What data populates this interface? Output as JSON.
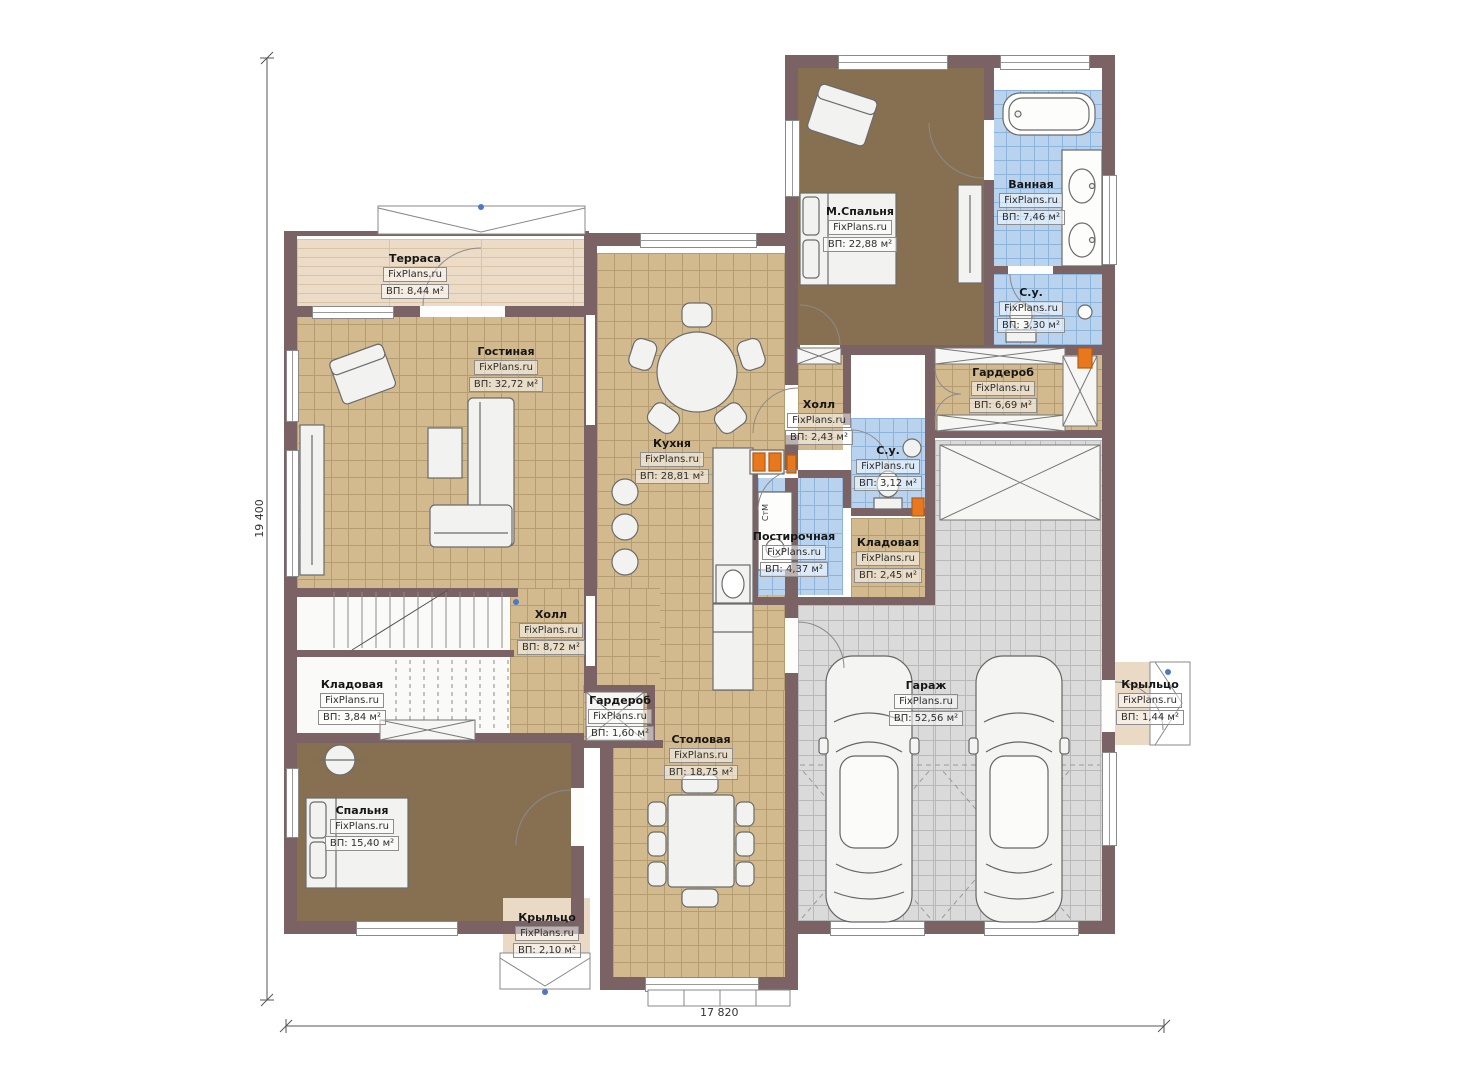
{
  "watermark": "FixPlans.ru",
  "dimensions": {
    "vertical": "19 400",
    "horizontal": "17 820"
  },
  "labels": {
    "washing_machine": "СтМ"
  },
  "rooms": [
    {
      "name": "Терраса",
      "area": "ВП: 8,44 м²"
    },
    {
      "name": "Гостиная",
      "area": "ВП: 32,72 м²"
    },
    {
      "name": "Кухня",
      "area": "ВП: 28,81 м²"
    },
    {
      "name": "М.Спальня",
      "area": "ВП: 22,88 м²"
    },
    {
      "name": "Ванная",
      "area": "ВП: 7,46 м²"
    },
    {
      "name": "С.у.",
      "area": "ВП: 3,30 м²"
    },
    {
      "name": "Холл",
      "area": "ВП: 2,43 м²"
    },
    {
      "name": "С.у.",
      "area": "ВП: 3,12 м²"
    },
    {
      "name": "Гардероб",
      "area": "ВП: 6,69 м²"
    },
    {
      "name": "Постирочная",
      "area": "ВП: 4,37 м²"
    },
    {
      "name": "Кладовая",
      "area": "ВП: 2,45 м²"
    },
    {
      "name": "Гараж",
      "area": "ВП: 52,56 м²"
    },
    {
      "name": "Холл",
      "area": "ВП: 8,72 м²"
    },
    {
      "name": "Кладовая",
      "area": "ВП: 3,84 м²"
    },
    {
      "name": "Гардероб",
      "area": "ВП: 1,60 м²"
    },
    {
      "name": "Столовая",
      "area": "ВП: 18,75 м²"
    },
    {
      "name": "Спальня",
      "area": "ВП: 15,40 м²"
    },
    {
      "name": "Крыльцо",
      "area": "ВП: 2,10 м²"
    },
    {
      "name": "Крыльцо",
      "area": "ВП: 1,44 м²"
    }
  ]
}
